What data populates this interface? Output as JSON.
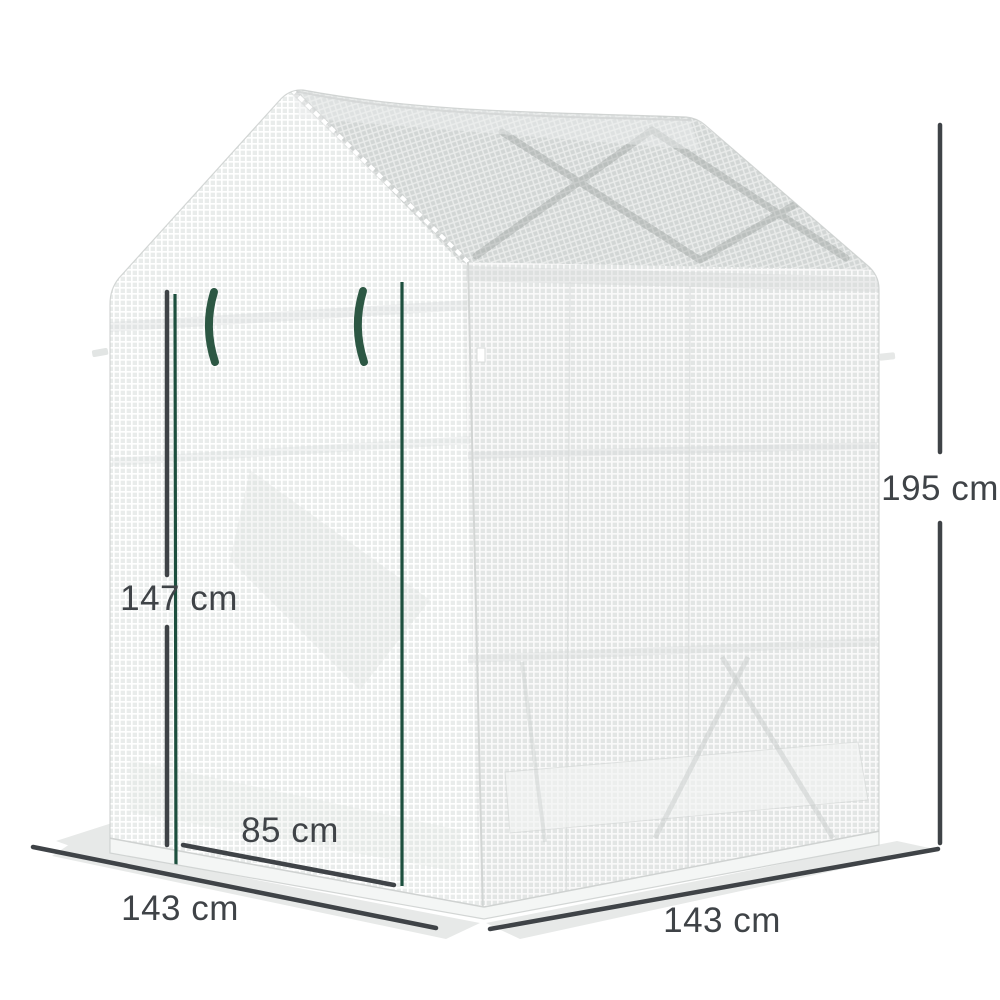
{
  "diagram": {
    "background": "#ffffff",
    "labels": {
      "overall_height": "195 cm",
      "door_height": "147 cm",
      "door_width": "85 cm",
      "base_side_left": "143 cm",
      "base_side_right": "143 cm"
    },
    "annotation_color": "#3f4347",
    "product_colors": {
      "cover_mesh_front": "#e9eceb",
      "cover_mesh_side": "#e5e8e7",
      "roof_mesh": "#d3d7d6",
      "zipper": "#1d4f3e",
      "tie": "#2c5743",
      "ground_shadow": "#e7e9e8"
    }
  }
}
